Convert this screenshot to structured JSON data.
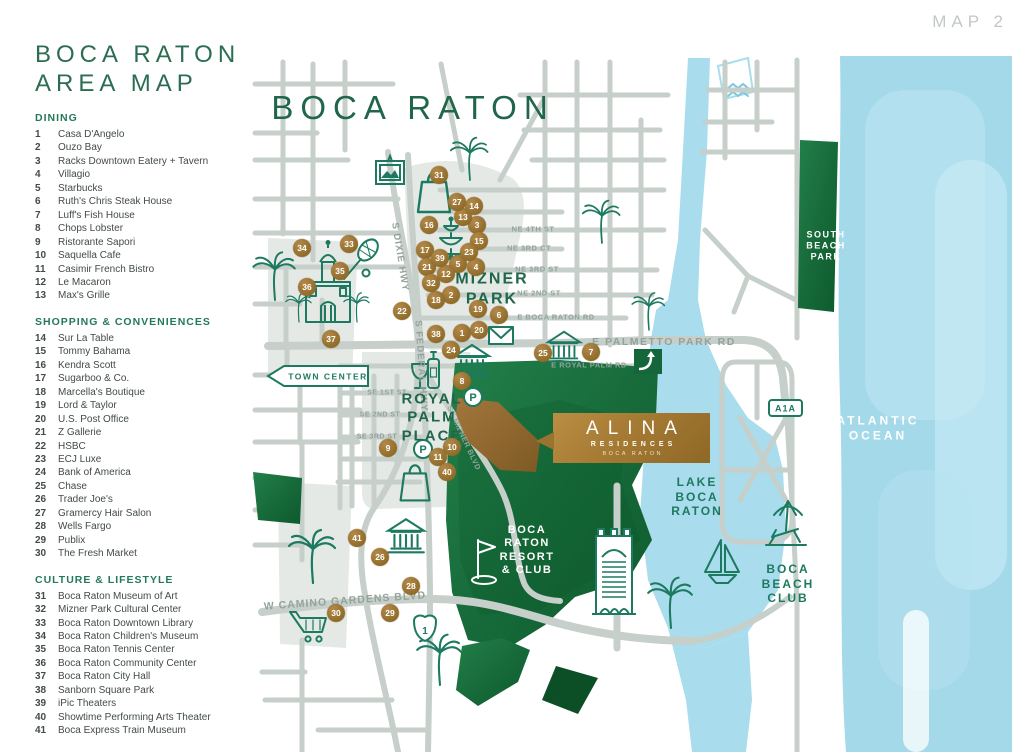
{
  "page": {
    "map_label": "MAP 2",
    "title_line1": "BOCA RATON",
    "title_line2": "AREA MAP"
  },
  "legend": {
    "sections": [
      {
        "heading": "DINING",
        "items": [
          {
            "num": "1",
            "label": "Casa D'Angelo"
          },
          {
            "num": "2",
            "label": "Ouzo Bay"
          },
          {
            "num": "3",
            "label": "Racks Downtown Eatery + Tavern"
          },
          {
            "num": "4",
            "label": "Villagio"
          },
          {
            "num": "5",
            "label": "Starbucks"
          },
          {
            "num": "6",
            "label": "Ruth's Chris Steak House"
          },
          {
            "num": "7",
            "label": "Luff's Fish House"
          },
          {
            "num": "8",
            "label": "Chops Lobster"
          },
          {
            "num": "9",
            "label": "Ristorante Sapori"
          },
          {
            "num": "10",
            "label": "Saquella Cafe"
          },
          {
            "num": "11",
            "label": "Casimir French Bistro"
          },
          {
            "num": "12",
            "label": "Le Macaron"
          },
          {
            "num": "13",
            "label": "Max's Grille"
          }
        ]
      },
      {
        "heading": "SHOPPING & CONVENIENCES",
        "items": [
          {
            "num": "14",
            "label": "Sur La Table"
          },
          {
            "num": "15",
            "label": "Tommy Bahama"
          },
          {
            "num": "16",
            "label": "Kendra Scott"
          },
          {
            "num": "17",
            "label": "Sugarboo & Co."
          },
          {
            "num": "18",
            "label": "Marcella's Boutique"
          },
          {
            "num": "19",
            "label": "Lord & Taylor"
          },
          {
            "num": "20",
            "label": "U.S. Post Office"
          },
          {
            "num": "21",
            "label": "Z Gallerie"
          },
          {
            "num": "22",
            "label": "HSBC"
          },
          {
            "num": "23",
            "label": "ECJ Luxe"
          },
          {
            "num": "24",
            "label": "Bank of America"
          },
          {
            "num": "25",
            "label": "Chase"
          },
          {
            "num": "26",
            "label": "Trader Joe's"
          },
          {
            "num": "27",
            "label": "Gramercy Hair Salon"
          },
          {
            "num": "28",
            "label": "Wells Fargo"
          },
          {
            "num": "29",
            "label": "Publix"
          },
          {
            "num": "30",
            "label": "The Fresh Market"
          }
        ]
      },
      {
        "heading": "CULTURE & LIFESTYLE",
        "items": [
          {
            "num": "31",
            "label": "Boca Raton Museum of Art"
          },
          {
            "num": "32",
            "label": "Mizner Park Cultural Center"
          },
          {
            "num": "33",
            "label": "Boca Raton Downtown Library"
          },
          {
            "num": "34",
            "label": "Boca Raton Children's Museum"
          },
          {
            "num": "35",
            "label": "Boca Raton Tennis Center"
          },
          {
            "num": "36",
            "label": "Boca Raton Community Center"
          },
          {
            "num": "37",
            "label": "Boca Raton City Hall"
          },
          {
            "num": "38",
            "label": "Sanborn Square Park"
          },
          {
            "num": "39",
            "label": "iPic Theaters"
          },
          {
            "num": "40",
            "label": "Showtime Performing Arts Theater"
          },
          {
            "num": "41",
            "label": "Boca Express Train Museum"
          }
        ]
      }
    ]
  },
  "map": {
    "colors": {
      "green": "#20664b",
      "teal": "#1d7a60",
      "white": "#ffffff",
      "gray": "#93a39c",
      "road": "#c6cfc9",
      "land": "#e5e9e6",
      "water": "#a9dcec",
      "park": "#1b6f3c",
      "marker_gold": "#95702f",
      "alina_gold": "#a77c34"
    },
    "area_labels": [
      {
        "t": "BOCA RATON",
        "x": 413,
        "y": 108,
        "s": 33,
        "c": "green",
        "ls": 7,
        "w": 500
      },
      {
        "t": "MIZNER\nPARK",
        "x": 492,
        "y": 289,
        "s": 16,
        "c": "green",
        "ls": 2,
        "w": 700
      },
      {
        "t": "ROYAL\nPALM\nPLACE",
        "x": 432,
        "y": 418,
        "s": 15,
        "c": "green",
        "ls": 2,
        "w": 700
      },
      {
        "t": "LAKE\nBOCA\nRATON",
        "x": 697,
        "y": 497,
        "s": 12,
        "c": "teal",
        "ls": 2,
        "w": 600
      },
      {
        "t": "BOCA\nBEACH\nCLUB",
        "x": 788,
        "y": 584,
        "s": 12,
        "c": "teal",
        "ls": 2,
        "w": 600
      },
      {
        "t": "ATLANTIC\nOCEAN",
        "x": 878,
        "y": 428,
        "s": 12,
        "c": "white",
        "ls": 3,
        "w": 600
      },
      {
        "t": "SOUTH\nBEACH\nPARK",
        "x": 826,
        "y": 246,
        "s": 9,
        "c": "white",
        "ls": 1.5,
        "w": 600
      },
      {
        "t": "BOCA\nRATON\nRESORT\n& CLUB",
        "x": 527,
        "y": 551,
        "s": 11,
        "c": "white",
        "ls": 1.5,
        "w": 600
      }
    ],
    "street_labels": [
      {
        "t": "NE 4TH ST",
        "x": 533,
        "y": 229,
        "s": 7.5
      },
      {
        "t": "NE 3RD CT",
        "x": 529,
        "y": 248,
        "s": 7.5
      },
      {
        "t": "NE 3RD ST",
        "x": 537,
        "y": 269,
        "s": 7.5
      },
      {
        "t": "NE 2ND ST",
        "x": 539,
        "y": 293,
        "s": 7.5
      },
      {
        "t": "E BOCA RATON RD",
        "x": 556,
        "y": 317,
        "s": 7.5
      },
      {
        "t": "E PALMETTO PARK RD",
        "x": 664,
        "y": 342,
        "s": 10.5,
        "ls": 1.5
      },
      {
        "t": "E ROYAL PALM RD",
        "x": 589,
        "y": 365,
        "s": 7.5
      },
      {
        "t": "SE 1ST ST",
        "x": 387,
        "y": 393,
        "s": 7
      },
      {
        "t": "SE 2ND ST",
        "x": 380,
        "y": 415,
        "s": 7
      },
      {
        "t": "SE 3RD ST",
        "x": 377,
        "y": 437,
        "s": 7
      },
      {
        "t": "W CAMINO GARDENS BLVD",
        "x": 345,
        "y": 601,
        "s": 10.5,
        "r": -4,
        "ls": 1
      },
      {
        "t": "S DIXIE HWY",
        "x": 400,
        "y": 257,
        "s": 9.5,
        "r": 81,
        "ls": 1
      },
      {
        "t": "S FEDERAL HWY",
        "x": 421,
        "y": 366,
        "s": 9.5,
        "r": 86,
        "ls": 1
      },
      {
        "t": "SE MIZNER BLVD",
        "x": 464,
        "y": 438,
        "s": 7.5,
        "r": 65
      }
    ],
    "markers": [
      {
        "n": "1",
        "x": 462,
        "y": 333
      },
      {
        "n": "2",
        "x": 451,
        "y": 295
      },
      {
        "n": "3",
        "x": 477,
        "y": 225
      },
      {
        "n": "4",
        "x": 476,
        "y": 267
      },
      {
        "n": "5",
        "x": 458,
        "y": 264
      },
      {
        "n": "6",
        "x": 499,
        "y": 315
      },
      {
        "n": "7",
        "x": 591,
        "y": 352
      },
      {
        "n": "8",
        "x": 462,
        "y": 381
      },
      {
        "n": "9",
        "x": 388,
        "y": 448
      },
      {
        "n": "10",
        "x": 452,
        "y": 447
      },
      {
        "n": "11",
        "x": 438,
        "y": 457
      },
      {
        "n": "12",
        "x": 446,
        "y": 274
      },
      {
        "n": "13",
        "x": 463,
        "y": 217
      },
      {
        "n": "14",
        "x": 474,
        "y": 206
      },
      {
        "n": "15",
        "x": 479,
        "y": 241
      },
      {
        "n": "16",
        "x": 429,
        "y": 225
      },
      {
        "n": "17",
        "x": 425,
        "y": 250
      },
      {
        "n": "18",
        "x": 436,
        "y": 300
      },
      {
        "n": "19",
        "x": 478,
        "y": 309
      },
      {
        "n": "20",
        "x": 479,
        "y": 330
      },
      {
        "n": "21",
        "x": 427,
        "y": 267
      },
      {
        "n": "22",
        "x": 402,
        "y": 311
      },
      {
        "n": "23",
        "x": 469,
        "y": 252
      },
      {
        "n": "24",
        "x": 451,
        "y": 350
      },
      {
        "n": "25",
        "x": 543,
        "y": 353
      },
      {
        "n": "26",
        "x": 380,
        "y": 557
      },
      {
        "n": "27",
        "x": 457,
        "y": 202
      },
      {
        "n": "28",
        "x": 411,
        "y": 586
      },
      {
        "n": "29",
        "x": 390,
        "y": 613
      },
      {
        "n": "30",
        "x": 336,
        "y": 613
      },
      {
        "n": "31",
        "x": 439,
        "y": 175
      },
      {
        "n": "32",
        "x": 431,
        "y": 283
      },
      {
        "n": "33",
        "x": 349,
        "y": 244
      },
      {
        "n": "34",
        "x": 302,
        "y": 248
      },
      {
        "n": "35",
        "x": 340,
        "y": 271
      },
      {
        "n": "36",
        "x": 307,
        "y": 287
      },
      {
        "n": "37",
        "x": 331,
        "y": 339
      },
      {
        "n": "38",
        "x": 436,
        "y": 334
      },
      {
        "n": "39",
        "x": 440,
        "y": 258
      },
      {
        "n": "40",
        "x": 447,
        "y": 472
      },
      {
        "n": "41",
        "x": 357,
        "y": 538
      }
    ],
    "signs": {
      "town_center": "TOWN CENTER",
      "a1a": "A1A",
      "us1": "1",
      "parking": "P"
    },
    "alina": {
      "name": "ALINA",
      "sub": "RESIDENCES",
      "city": "BOCA RATON"
    }
  }
}
